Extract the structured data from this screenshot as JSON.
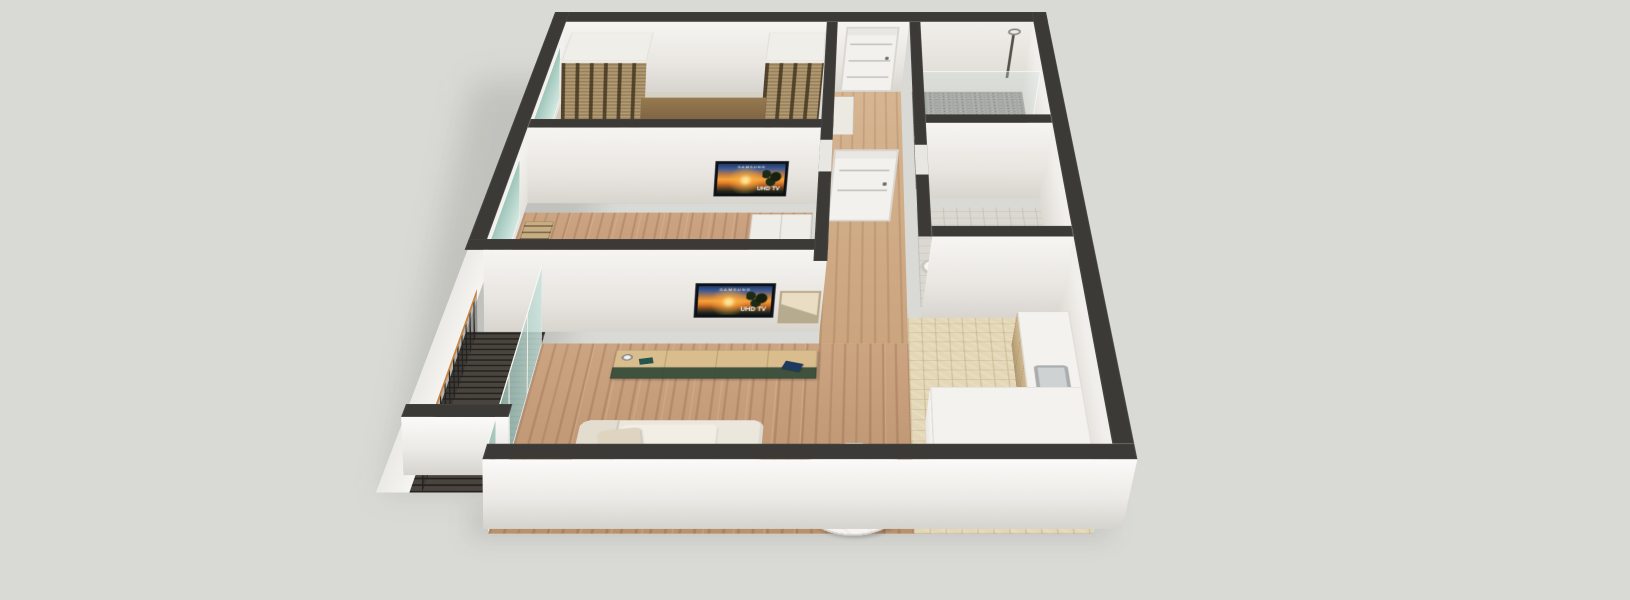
{
  "scene": {
    "title": "apartment-3d-floorplan",
    "style": "isometric dollhouse cutaway render, no visible UI chrome",
    "background": "#d9dad5",
    "tv": {
      "brand": "SAMSUNG",
      "label": "UHD TV"
    },
    "palette": {
      "wall_top": "#3b3a37",
      "wall_face": "#f3f1ed",
      "facade": "#f7f6f3",
      "living_wood_floor": "#c69a74",
      "hall_wood_floor": "#d2ab83",
      "bedroom_floor": "#c9c2b3",
      "kitchen_tile": "#e4d7b7",
      "bathroom_mosaic": "#93918b",
      "wc_tile": "#dbd8d1",
      "balcony_deck": "#3f3a34",
      "rattan_wardrobe": "#a98e64",
      "furniture_wood": "#d9bd8d",
      "drawer_green": "#2e4636",
      "accent_orange": "#d9622f",
      "handrail_orange": "#c8843e",
      "glass_teal": "#a8cfc3",
      "counter_white": "#f4f2ee",
      "headboard_wood": "#8a6e4b"
    },
    "rooms": [
      {
        "id": "bedroom",
        "name": "Master bedroom",
        "contents": [
          "double bed",
          "two pillows",
          "wood headboard",
          "two nightstands with lamps",
          "rattan wardrobes both sides",
          "west window"
        ]
      },
      {
        "id": "bedroom2",
        "name": "Second bedroom / study",
        "contents": [
          "wall-mounted TV",
          "desk with laptop",
          "office chair",
          "bookshelf",
          "white wardrobe",
          "west window"
        ]
      },
      {
        "id": "living",
        "name": "Living / dining room",
        "contents": [
          "wall-mounted TV",
          "wood TV console with green drawers",
          "leaning art frame",
          "cream sofa",
          "orange cushion",
          "marble dining table",
          "potted plant",
          "two orange tub chairs",
          "glass wall to balcony"
        ]
      },
      {
        "id": "kitchen",
        "name": "Kitchen",
        "contents": [
          "beige stone tile floor",
          "L-shaped white counter with wood front",
          "sink"
        ]
      },
      {
        "id": "bathroom",
        "name": "Shower room",
        "contents": [
          "gray mosaic floor",
          "glass partition",
          "shower head"
        ]
      },
      {
        "id": "wc",
        "name": "WC",
        "contents": [
          "toilet",
          "round washbasin"
        ]
      },
      {
        "id": "hallway",
        "name": "Entry hallway",
        "contents": [
          "entrance door",
          "interior door",
          "cabinet"
        ]
      },
      {
        "id": "balcony",
        "name": "Balcony",
        "contents": [
          "dark slat railing with orange wood handrail",
          "dark decking"
        ]
      }
    ]
  }
}
